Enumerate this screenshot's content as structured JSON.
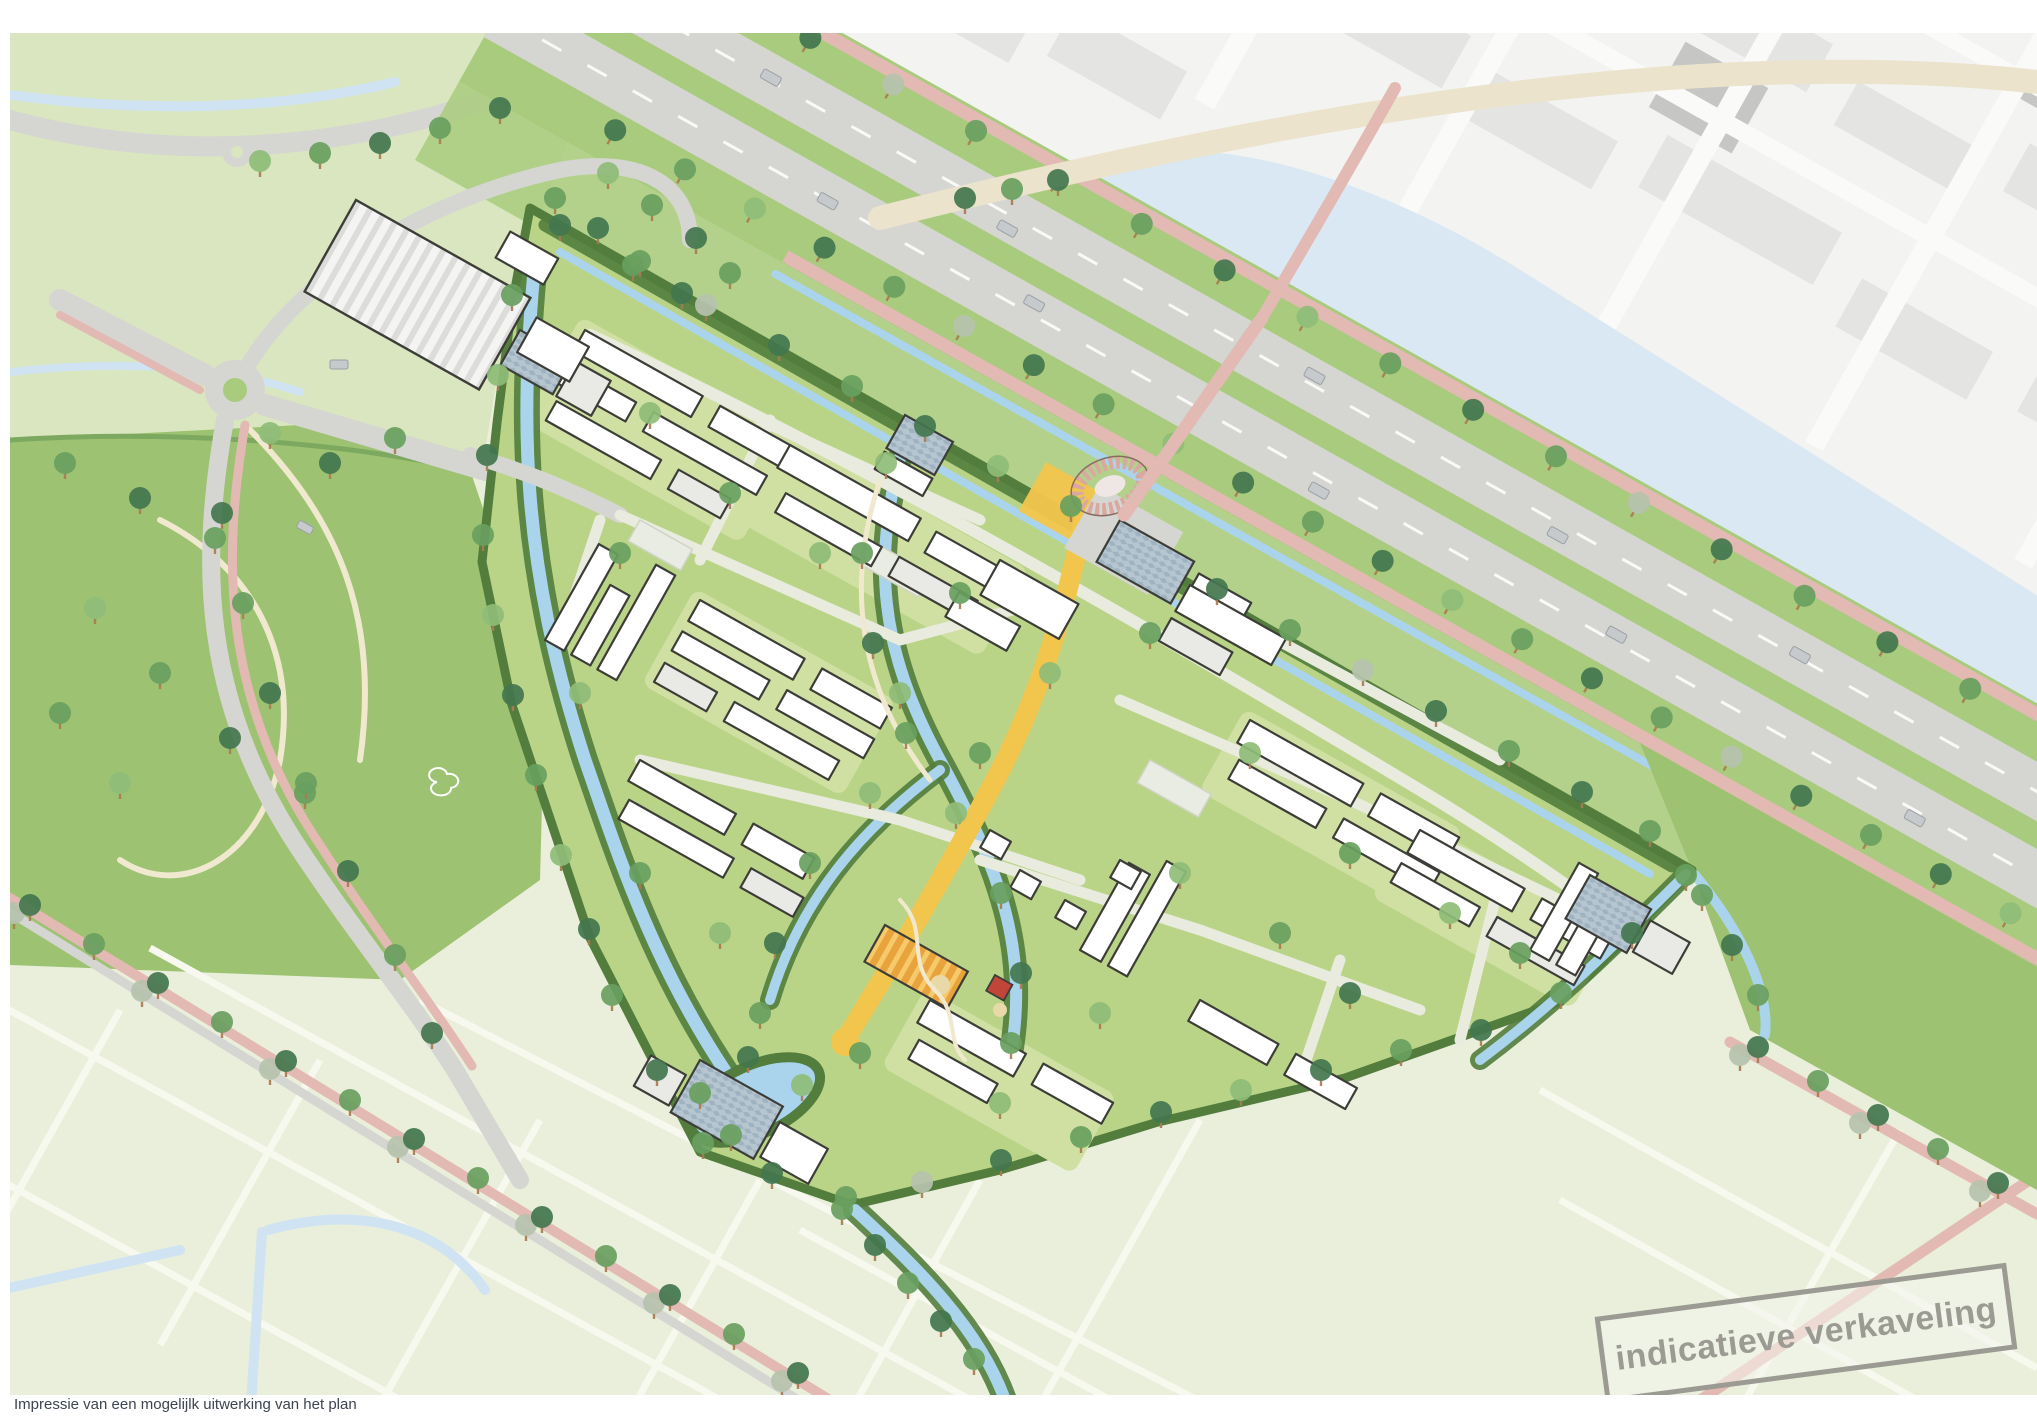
{
  "document": {
    "caption": "Impressie van een mogelijlk uitwerking van het plan",
    "stamp": "indicatieve verkaveling"
  },
  "palette": {
    "field_pale": "#e9efdb",
    "field_nw": "#d9e6bf",
    "field_line": "#f7f9ef",
    "meadow": "#9dc272",
    "verge": "#a9cb7d",
    "dev_grass": "#bad487",
    "courtyard": "#cfe0a2",
    "bank": "#527d3d",
    "hedge": "#7ca95f",
    "water_canal": "#a9d4ec",
    "water_wide": "#d9e8f3",
    "water_ditch": "#cfe3f2",
    "road": "#d5d6d2",
    "road_minor": "#e8ebde",
    "path_pink": "#e2b9b3",
    "path_cream": "#f0e9cf",
    "street_yellow": "#f2c64d",
    "building_fill": "#ffffff",
    "building_side": "#e9e9e6",
    "building_line": "#3d3d38",
    "solar_roof": "#b6c6d1",
    "barn_orange": "#e8a33d",
    "pavilion_pink": "#d9a8a0",
    "city_bg": "#f3f3f1",
    "city_block": "#e4e4e3",
    "city_block_dark": "#c6c6c5",
    "city_road_beige": "#ebe3cc",
    "tree_dark": "#44774f",
    "tree_mid": "#69a05f",
    "tree_light": "#8fbd78",
    "tree_pale": "#b7c3ae",
    "trunk": "#a97c52",
    "car": "#c6cacd",
    "parking": "#e9ece2",
    "stamp": "#9b9b93",
    "caption": "#3d4450"
  }
}
